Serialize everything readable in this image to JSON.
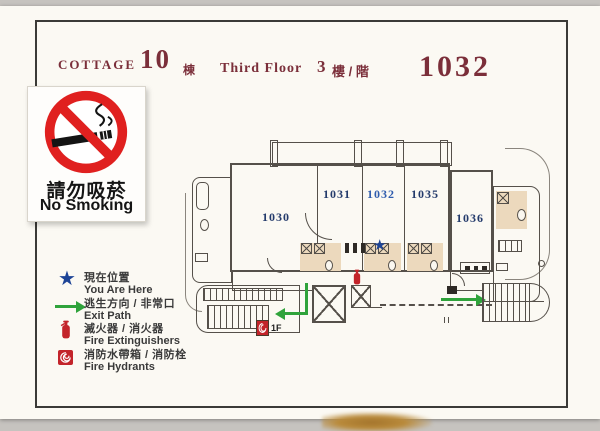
{
  "header": {
    "cottage_label": "COTTAGE",
    "cottage_number": "10",
    "cottage_suffix": "棟",
    "floor_label_en": "Third Floor",
    "floor_number": "3",
    "floor_suffix": "樓 / 階",
    "room_number": "1032"
  },
  "no_smoking": {
    "title_zh": "請勿吸菸",
    "title_en": "No Smoking"
  },
  "legend": {
    "items": [
      {
        "icon": "you-are-here-star",
        "zh": "現在位置",
        "en": "You Are Here"
      },
      {
        "icon": "exit-path-arrow",
        "zh": "逃生方向 / 非常口",
        "en": "Exit Path"
      },
      {
        "icon": "fire-extinguisher",
        "zh": "滅火器 / 消火器",
        "en": "Fire Extinguishers"
      },
      {
        "icon": "fire-hydrant",
        "zh": "消防水帶箱 / 消防栓",
        "en": "Fire Hydrants"
      }
    ]
  },
  "floor_plan": {
    "rooms": [
      {
        "number": "1030",
        "current": false
      },
      {
        "number": "1031",
        "current": false
      },
      {
        "number": "1032",
        "current": true
      },
      {
        "number": "1035",
        "current": false
      },
      {
        "number": "1036",
        "current": false
      }
    ],
    "floor_marker": "1F",
    "you_are_here_symbol": "★"
  },
  "colors": {
    "header_maroon": "#7b2f3a",
    "room_number_navy": "#233a6b",
    "current_room_blue": "#2f5cad",
    "exit_green": "#2fa33b",
    "alert_red": "#c3242a",
    "no_smoking_red": "#e0201f",
    "star_blue": "#1d4496",
    "plan_line": "#55504a",
    "tan_accent": "#ecd9bd"
  }
}
